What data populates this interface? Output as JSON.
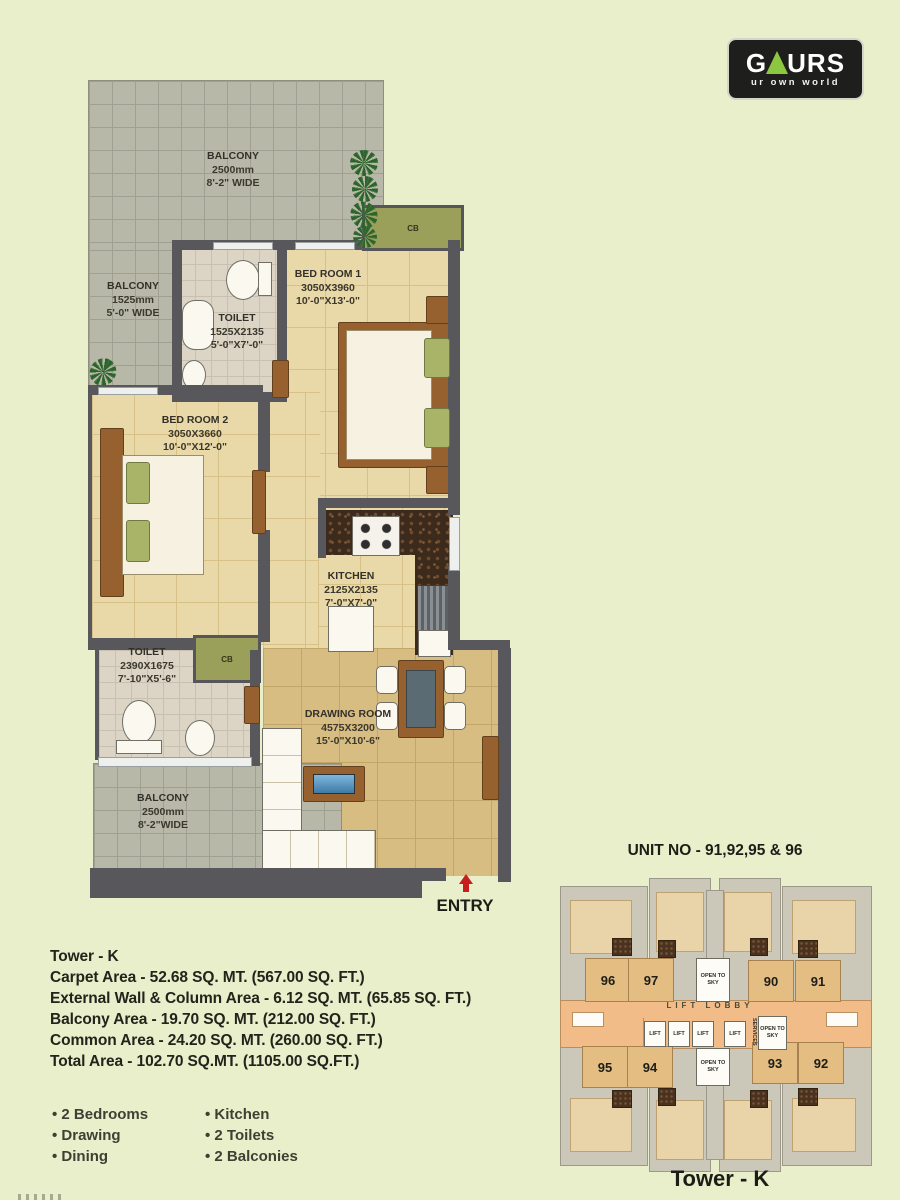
{
  "logo": {
    "brand_left": "G",
    "brand_right": "URS",
    "tagline": "ur own world"
  },
  "floorplan": {
    "cb_label": "CB",
    "entry_label": "ENTRY",
    "rooms": {
      "balcony_top": {
        "name": "BALCONY",
        "l1": "2500mm",
        "l2": "8'-2\" WIDE"
      },
      "balcony_left": {
        "name": "BALCONY",
        "l1": "1525mm",
        "l2": "5'-0\" WIDE"
      },
      "toilet1": {
        "name": "TOILET",
        "l1": "1525X2135",
        "l2": "5'-0\"X7'-0\""
      },
      "bedroom1": {
        "name": "BED ROOM 1",
        "l1": "3050X3960",
        "l2": "10'-0\"X13'-0\""
      },
      "bedroom2": {
        "name": "BED ROOM 2",
        "l1": "3050X3660",
        "l2": "10'-0\"X12'-0\""
      },
      "kitchen": {
        "name": "KITCHEN",
        "l1": "2125X2135",
        "l2": "7'-0\"X7'-0\""
      },
      "toilet2": {
        "name": "TOILET",
        "l1": "2390X1675",
        "l2": "7'-10\"X5'-6\""
      },
      "drawing": {
        "name": "DRAWING ROOM",
        "l1": "4575X3200",
        "l2": "15'-0\"X10'-6\""
      },
      "balcony_bottom": {
        "name": "BALCONY",
        "l1": "2500mm",
        "l2": "8'-2\"WIDE"
      }
    }
  },
  "details": {
    "tower": "Tower - K",
    "lines": [
      "Carpet Area - 52.68 SQ. MT. (567.00 SQ. FT.)",
      "External Wall & Column Area - 6.12 SQ. MT. (65.85 SQ. FT.)",
      "Balcony Area - 19.70 SQ. MT. (212.00 SQ. FT.)",
      "Common Area - 24.20 SQ. MT. (260.00 SQ. FT.)",
      "Total Area - 102.70 SQ.MT. (1105.00 SQ.FT.)"
    ]
  },
  "features": {
    "col1": [
      "2 Bedrooms",
      "Drawing",
      "Dining"
    ],
    "col2": [
      "Kitchen",
      "2 Toilets",
      "2 Balconies"
    ]
  },
  "keyplan": {
    "title": "UNIT NO - 91,92,95 & 96",
    "caption": "Tower -  K",
    "lift_lobby": "LIFT LOBBY",
    "services": "SERVICES",
    "open_to_sky": "OPEN TO SKY",
    "lift": "LIFT",
    "units_top": [
      "96",
      "97",
      "90",
      "91"
    ],
    "units_bottom": [
      "95",
      "94",
      "93",
      "92"
    ]
  },
  "colors": {
    "accent_green": "#8dc63f",
    "entry_red": "#c81e1e",
    "wall": "#57575c",
    "background": "#e9efca"
  }
}
